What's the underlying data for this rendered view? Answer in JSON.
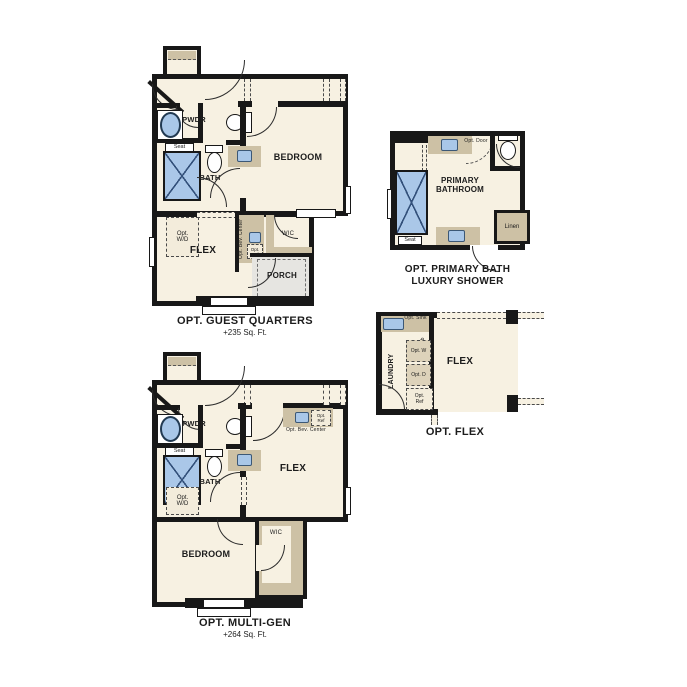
{
  "colors": {
    "background": "#ffffff",
    "wall": "#181818",
    "room_fill": "#f7f1e2",
    "counter_tan": "#cdc1a5",
    "fixture_blue": "#a9c7e8",
    "porch_gray": "#e6e5e1",
    "text": "#1c1c1c"
  },
  "plans": {
    "guest_quarters": {
      "title": "OPT. GUEST QUARTERS",
      "subtitle": "+235 Sq. Ft.",
      "labels": {
        "pwdr": "PWDR",
        "seat": "Seat",
        "bath": "BATH",
        "opt_wd": "Opt. W/D",
        "bedroom": "BEDROOM",
        "flex": "FLEX",
        "opt_bev_center": "Opt. Bev. Center",
        "opt_ref": "Opt. Ref",
        "wic": "WIC",
        "porch": "PORCH"
      }
    },
    "primary_bath": {
      "title": "OPT. PRIMARY BATH",
      "subtitle": "LUXURY SHOWER",
      "labels": {
        "opt_door": "Opt. Door",
        "primary_bathroom": "PRIMARY BATHROOM",
        "seat": "Seat",
        "linen": "Linen"
      }
    },
    "opt_flex": {
      "title": "OPT. FLEX",
      "labels": {
        "opt_sink": "Opt. Sink",
        "opt_cab": "Opt. Cab",
        "laundry": "LAUNDRY",
        "opt_w": "Opt. W",
        "opt_d": "Opt. D",
        "opt_ref": "Opt. Ref",
        "flex": "FLEX"
      }
    },
    "multi_gen": {
      "title": "OPT. MULTI-GEN",
      "subtitle": "+264 Sq. Ft.",
      "labels": {
        "pwdr": "PWDR",
        "seat": "Seat",
        "bath": "BATH",
        "opt_wd": "Opt. W/D",
        "opt_ref": "Opt. Ref",
        "opt_bev_center": "Opt. Bev. Center",
        "flex": "FLEX",
        "bedroom": "BEDROOM",
        "wic": "WIC"
      }
    }
  }
}
